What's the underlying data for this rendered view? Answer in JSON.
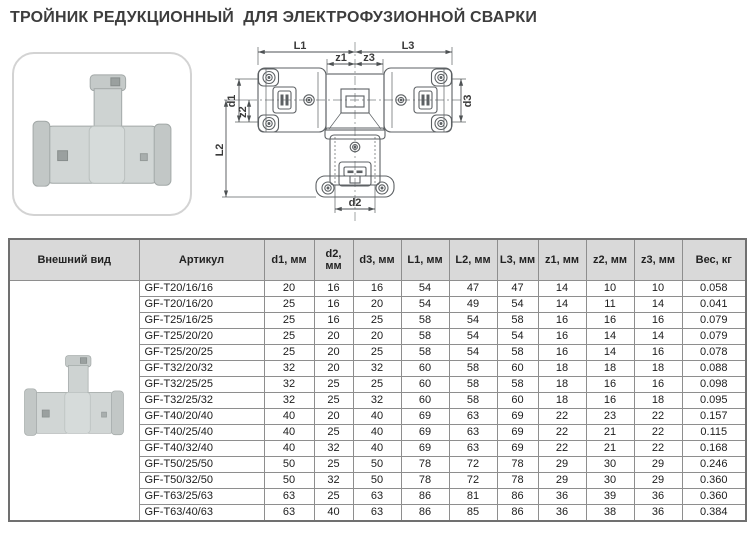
{
  "page": {
    "title": "ТРОЙНИК РЕДУКЦИОННЫЙ  ДЛЯ ЭЛЕКТРОФУЗИОННОЙ СВАРКИ"
  },
  "diagram": {
    "labels": {
      "L1": "L1",
      "L3": "L3",
      "z1": "z1",
      "z3": "z3",
      "d1": "d1",
      "z2": "z2",
      "L2": "L2",
      "d3": "d3",
      "d2": "d2"
    }
  },
  "colors": {
    "header_bg": "#d9d9d9",
    "grid": "#8e8e8e",
    "title": "#3d3d3d",
    "line": "#5d6164"
  },
  "images": {
    "product_photo": "grey-polypropylene-tee-fitting",
    "row_thumbnail": "grey-polypropylene-tee-fitting"
  },
  "table": {
    "headers": [
      "Внешний вид",
      "Артикул",
      "d1, мм",
      "d2, мм",
      "d3, мм",
      "L1, мм",
      "L2, мм",
      "L3, мм",
      "z1, мм",
      "z2, мм",
      "z3, мм",
      "Вес, кг"
    ],
    "rows": [
      {
        "article": "GF-T20/16/16",
        "d1": "20",
        "d2": "16",
        "d3": "16",
        "L1": "54",
        "L2": "47",
        "L3": "47",
        "z1": "14",
        "z2": "10",
        "z3": "10",
        "weight": "0.058"
      },
      {
        "article": "GF-T20/16/20",
        "d1": "25",
        "d2": "16",
        "d3": "20",
        "L1": "54",
        "L2": "49",
        "L3": "54",
        "z1": "14",
        "z2": "11",
        "z3": "14",
        "weight": "0.041"
      },
      {
        "article": "GF-T25/16/25",
        "d1": "25",
        "d2": "16",
        "d3": "25",
        "L1": "58",
        "L2": "54",
        "L3": "58",
        "z1": "16",
        "z2": "16",
        "z3": "16",
        "weight": "0.079"
      },
      {
        "article": "GF-T25/20/20",
        "d1": "25",
        "d2": "20",
        "d3": "20",
        "L1": "58",
        "L2": "54",
        "L3": "54",
        "z1": "16",
        "z2": "14",
        "z3": "14",
        "weight": "0.079"
      },
      {
        "article": "GF-T25/20/25",
        "d1": "25",
        "d2": "20",
        "d3": "25",
        "L1": "58",
        "L2": "54",
        "L3": "58",
        "z1": "16",
        "z2": "14",
        "z3": "16",
        "weight": "0.078"
      },
      {
        "article": "GF-T32/20/32",
        "d1": "32",
        "d2": "20",
        "d3": "32",
        "L1": "60",
        "L2": "58",
        "L3": "60",
        "z1": "18",
        "z2": "18",
        "z3": "18",
        "weight": "0.088"
      },
      {
        "article": "GF-T32/25/25",
        "d1": "32",
        "d2": "25",
        "d3": "25",
        "L1": "60",
        "L2": "58",
        "L3": "58",
        "z1": "18",
        "z2": "16",
        "z3": "16",
        "weight": "0.098"
      },
      {
        "article": "GF-T32/25/32",
        "d1": "32",
        "d2": "25",
        "d3": "32",
        "L1": "60",
        "L2": "58",
        "L3": "60",
        "z1": "18",
        "z2": "16",
        "z3": "18",
        "weight": "0.095"
      },
      {
        "article": "GF-T40/20/40",
        "d1": "40",
        "d2": "20",
        "d3": "40",
        "L1": "69",
        "L2": "63",
        "L3": "69",
        "z1": "22",
        "z2": "23",
        "z3": "22",
        "weight": "0.157"
      },
      {
        "article": "GF-T40/25/40",
        "d1": "40",
        "d2": "25",
        "d3": "40",
        "L1": "69",
        "L2": "63",
        "L3": "69",
        "z1": "22",
        "z2": "21",
        "z3": "22",
        "weight": "0.115"
      },
      {
        "article": "GF-T40/32/40",
        "d1": "40",
        "d2": "32",
        "d3": "40",
        "L1": "69",
        "L2": "63",
        "L3": "69",
        "z1": "22",
        "z2": "21",
        "z3": "22",
        "weight": "0.168"
      },
      {
        "article": "GF-T50/25/50",
        "d1": "50",
        "d2": "25",
        "d3": "50",
        "L1": "78",
        "L2": "72",
        "L3": "78",
        "z1": "29",
        "z2": "30",
        "z3": "29",
        "weight": "0.246"
      },
      {
        "article": "GF-T50/32/50",
        "d1": "50",
        "d2": "32",
        "d3": "50",
        "L1": "78",
        "L2": "72",
        "L3": "78",
        "z1": "29",
        "z2": "30",
        "z3": "29",
        "weight": "0.360"
      },
      {
        "article": "GF-T63/25/63",
        "d1": "63",
        "d2": "25",
        "d3": "63",
        "L1": "86",
        "L2": "81",
        "L3": "86",
        "z1": "36",
        "z2": "39",
        "z3": "36",
        "weight": "0.360"
      },
      {
        "article": "GF-T63/40/63",
        "d1": "63",
        "d2": "40",
        "d3": "63",
        "L1": "86",
        "L2": "85",
        "L3": "86",
        "z1": "36",
        "z2": "38",
        "z3": "36",
        "weight": "0.384"
      }
    ]
  }
}
